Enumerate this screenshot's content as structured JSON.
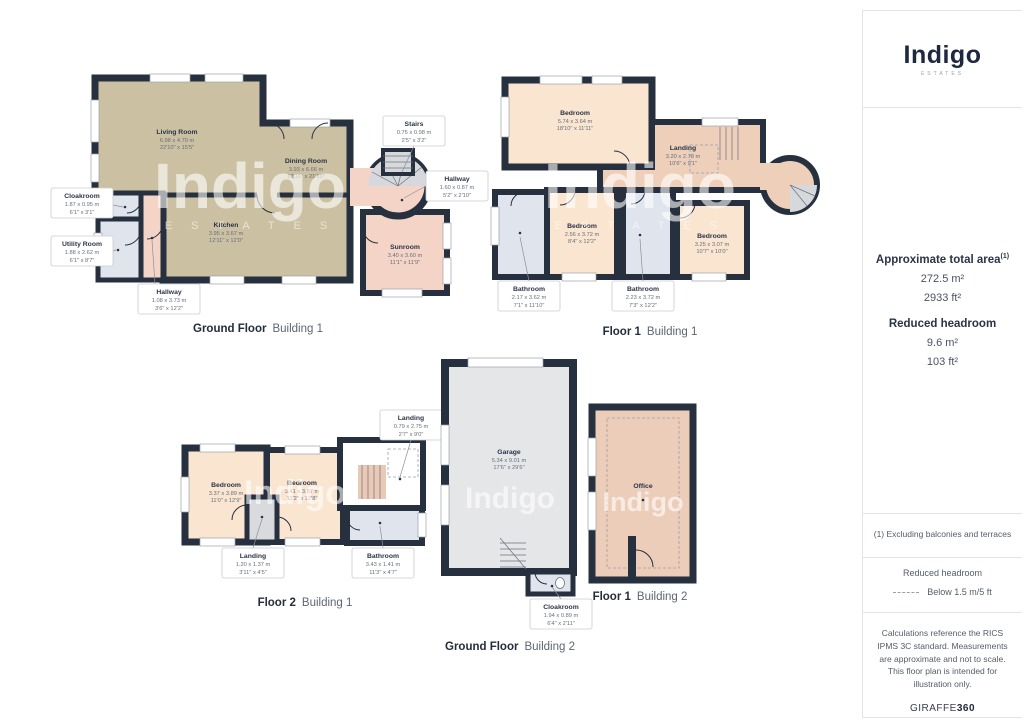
{
  "watermark": {
    "text": "Indigo",
    "subtext": "E S T A T E S"
  },
  "sidebar": {
    "logo": "Indigo",
    "logo_sub": "ESTATES",
    "area_title": "Approximate total area",
    "area_sup": "(1)",
    "area_m": "272.5 m²",
    "area_ft": "2933 ft²",
    "headroom_title": "Reduced headroom",
    "headroom_m": "9.6 m²",
    "headroom_ft": "103 ft²",
    "footnote": "(1) Excluding balconies and terraces",
    "legend_title": "Reduced headroom",
    "legend_label": "Below 1.5 m/5 ft",
    "disclaimer": "Calculations reference the RICS IPMS 3C standard. Measurements are approximate and not to scale. This floor plan is intended for illustration only.",
    "brand": "GIRAFFE",
    "brand_suffix": "360"
  },
  "plans": {
    "gf_b1": {
      "caption": "Ground Floor",
      "building": "Building 1",
      "rooms": {
        "living": {
          "name": "Living Room",
          "m": "6.98 x 4.70 m",
          "ft": "22'10\" x 15'5\""
        },
        "dining": {
          "name": "Dining Room",
          "m": "3.93 x 6.66 m",
          "ft": "12'10\" x 21'10\""
        },
        "kitchen": {
          "name": "Kitchen",
          "m": "3.95 x 3.67 m",
          "ft": "12'11\" x 12'0\""
        },
        "cloakroom": {
          "name": "Cloakroom",
          "m": "1.87 x 0.95 m",
          "ft": "6'1\" x 3'1\""
        },
        "utility": {
          "name": "Utility Room",
          "m": "1.88 x 2.62 m",
          "ft": "6'1\" x 8'7\""
        },
        "hallway": {
          "name": "Hallway",
          "m": "1.08 x 3.73 m",
          "ft": "3'6\" x 12'2\""
        },
        "stairs": {
          "name": "Stairs",
          "m": "0.75 x 0.98 m",
          "ft": "2'5\" x 3'2\""
        },
        "hallway2": {
          "name": "Hallway",
          "m": "1.60 x 0.87 m",
          "ft": "5'2\" x 2'10\""
        },
        "sunroom": {
          "name": "Sunroom",
          "m": "3.40 x 3.60 m",
          "ft": "11'1\" x 11'9\""
        }
      }
    },
    "f1_b1": {
      "caption": "Floor 1",
      "building": "Building 1",
      "rooms": {
        "bedroom1": {
          "name": "Bedroom",
          "m": "5.74 x 3.64 m",
          "ft": "18'10\" x 11'11\""
        },
        "landing": {
          "name": "Landing",
          "m": "3.20 x 2.78 m",
          "ft": "10'6\" x 9'1\""
        },
        "bedroom2": {
          "name": "Bedroom",
          "m": "2.56 x 3.72 m",
          "ft": "8'4\" x 12'2\""
        },
        "bedroom3": {
          "name": "Bedroom",
          "m": "3.25 x 3.07 m",
          "ft": "10'7\" x 10'0\""
        },
        "bathroom1": {
          "name": "Bathroom",
          "m": "2.17 x 3.62 m",
          "ft": "7'1\" x 11'10\""
        },
        "bathroom2": {
          "name": "Bathroom",
          "m": "2.23 x 3.72 m",
          "ft": "7'3\" x 12'2\""
        }
      }
    },
    "f2_b1": {
      "caption": "Floor 2",
      "building": "Building 1",
      "rooms": {
        "bedroom1": {
          "name": "Bedroom",
          "m": "3.37 x 3.89 m",
          "ft": "11'0\" x 12'9\""
        },
        "bedroom2": {
          "name": "Bedroom",
          "m": "3.41 x 3.87 m",
          "ft": "11'2\" x 12'8\""
        },
        "landing_top": {
          "name": "Landing",
          "m": "0.79 x 2.75 m",
          "ft": "2'7\" x 9'0\""
        },
        "landing": {
          "name": "Landing",
          "m": "1.20 x 1.37 m",
          "ft": "3'11\" x 4'5\""
        },
        "bathroom": {
          "name": "Bathroom",
          "m": "3.43 x 1.41 m",
          "ft": "11'3\" x 4'7\""
        }
      }
    },
    "gf_b2": {
      "caption": "Ground Floor",
      "building": "Building 2",
      "rooms": {
        "garage": {
          "name": "Garage",
          "m": "5.34 x 9.01 m",
          "ft": "17'6\" x 29'6\""
        },
        "cloakroom": {
          "name": "Cloakroom",
          "m": "1.94 x 0.89 m",
          "ft": "6'4\" x 2'11\""
        }
      }
    },
    "f1_b2": {
      "caption": "Floor 1",
      "building": "Building 2",
      "rooms": {
        "office": {
          "name": "Office"
        }
      }
    }
  }
}
